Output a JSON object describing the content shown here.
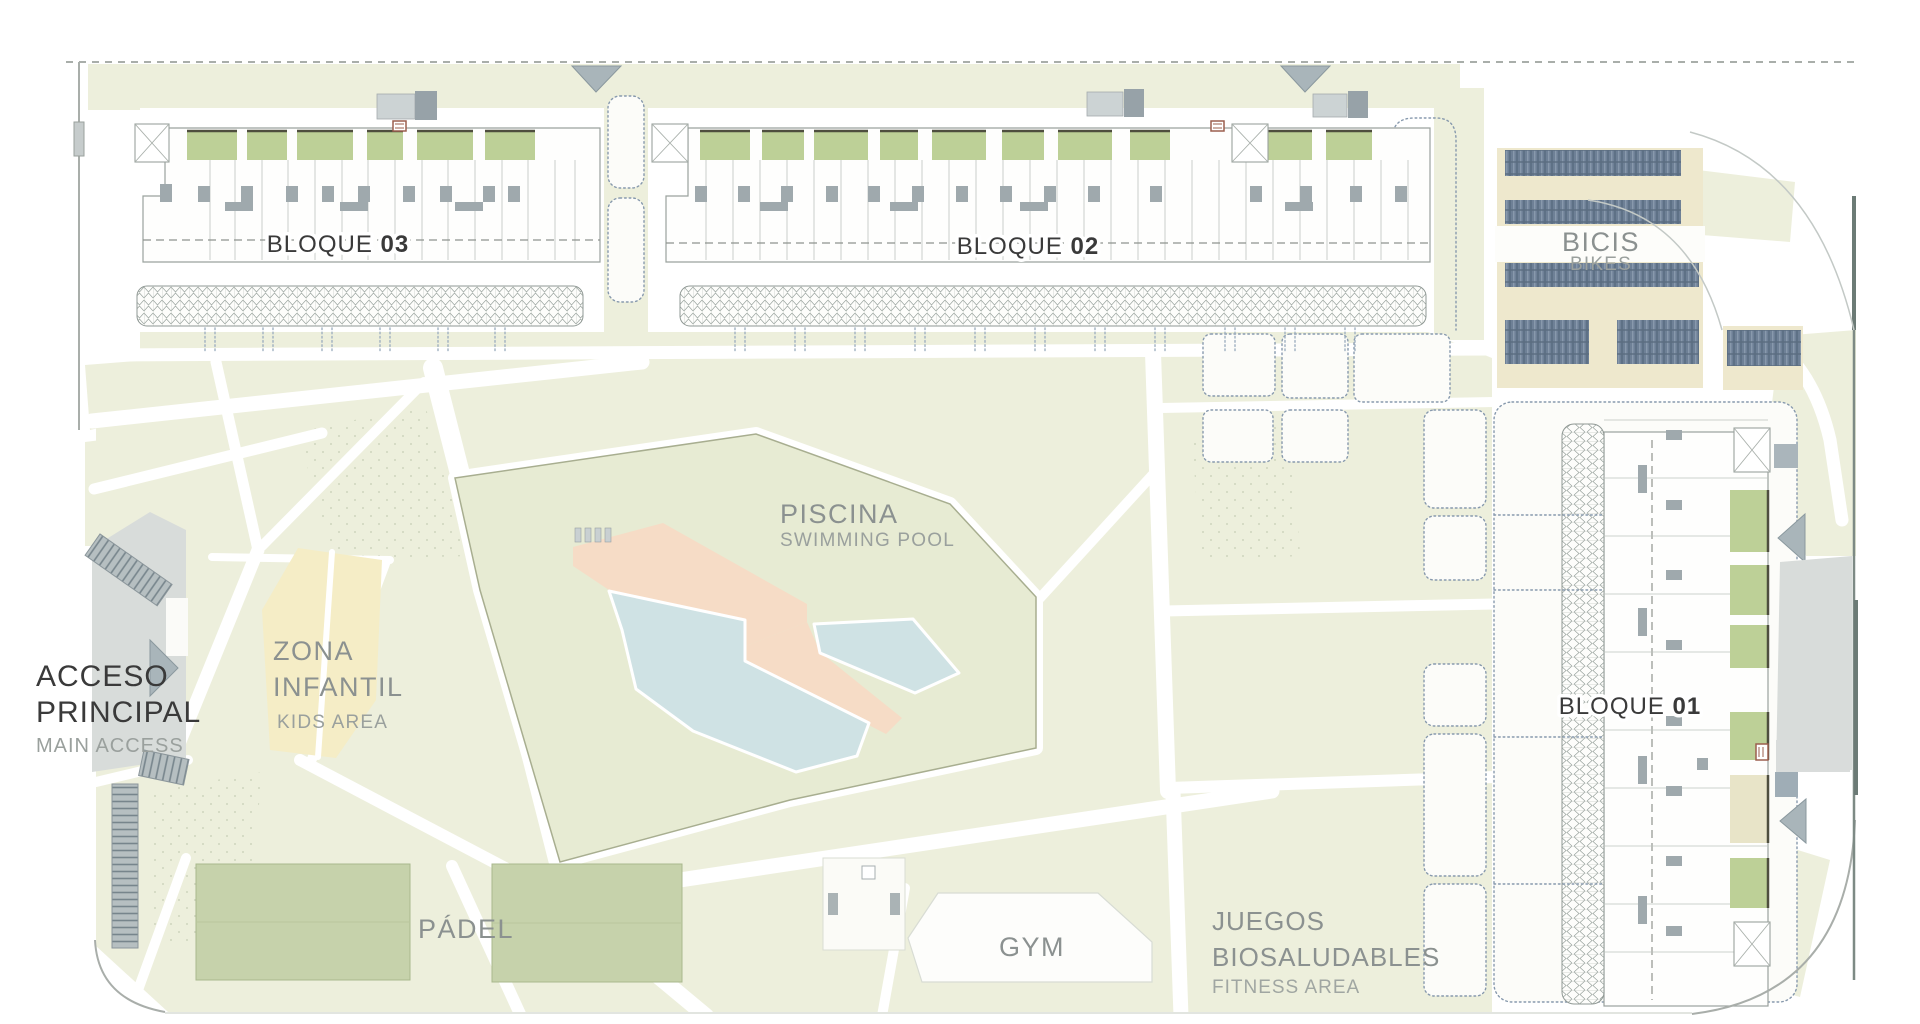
{
  "plan": {
    "blocks": {
      "b01": {
        "prefix": "BLOQUE",
        "number": "01"
      },
      "b02": {
        "prefix": "BLOQUE",
        "number": "02"
      },
      "b03": {
        "prefix": "BLOQUE",
        "number": "03"
      }
    },
    "areas": {
      "piscina": {
        "title": "PISCINA",
        "subtitle": "SWIMMING POOL"
      },
      "zona_infantil": {
        "title_line1": "ZONA",
        "title_line2": "INFANTIL",
        "subtitle": "KIDS AREA"
      },
      "acceso_principal": {
        "title_line1": "ACCESO",
        "title_line2": "PRINCIPAL",
        "subtitle": "MAIN ACCESS"
      },
      "padel": {
        "title": "PÁDEL"
      },
      "gym": {
        "title": "GYM"
      },
      "juegos_biosaludables": {
        "title_line1": "JUEGOS",
        "title_line2": "BIOSALUDABLES",
        "subtitle": "FITNESS AREA"
      },
      "bicis": {
        "title": "BICIS",
        "subtitle": "BIKES"
      }
    },
    "colors": {
      "lawn": "#edefdc",
      "lawnDark": "#e7ebd3",
      "poolWater": "#cfe2e4",
      "poolDeck": "#f6dcc6",
      "court": "#c6d2ab",
      "patio": "#bdd097",
      "kids": "#f5edc6",
      "bike": "#6e8096",
      "bikeBed": "#eee8cd",
      "road": "#d8dcda",
      "boundary": "#b18e86",
      "wall": "#9aa29e",
      "textDark": "#3a3a3a",
      "textGray": "#8b9190",
      "marker": "#a9b5ba"
    }
  }
}
